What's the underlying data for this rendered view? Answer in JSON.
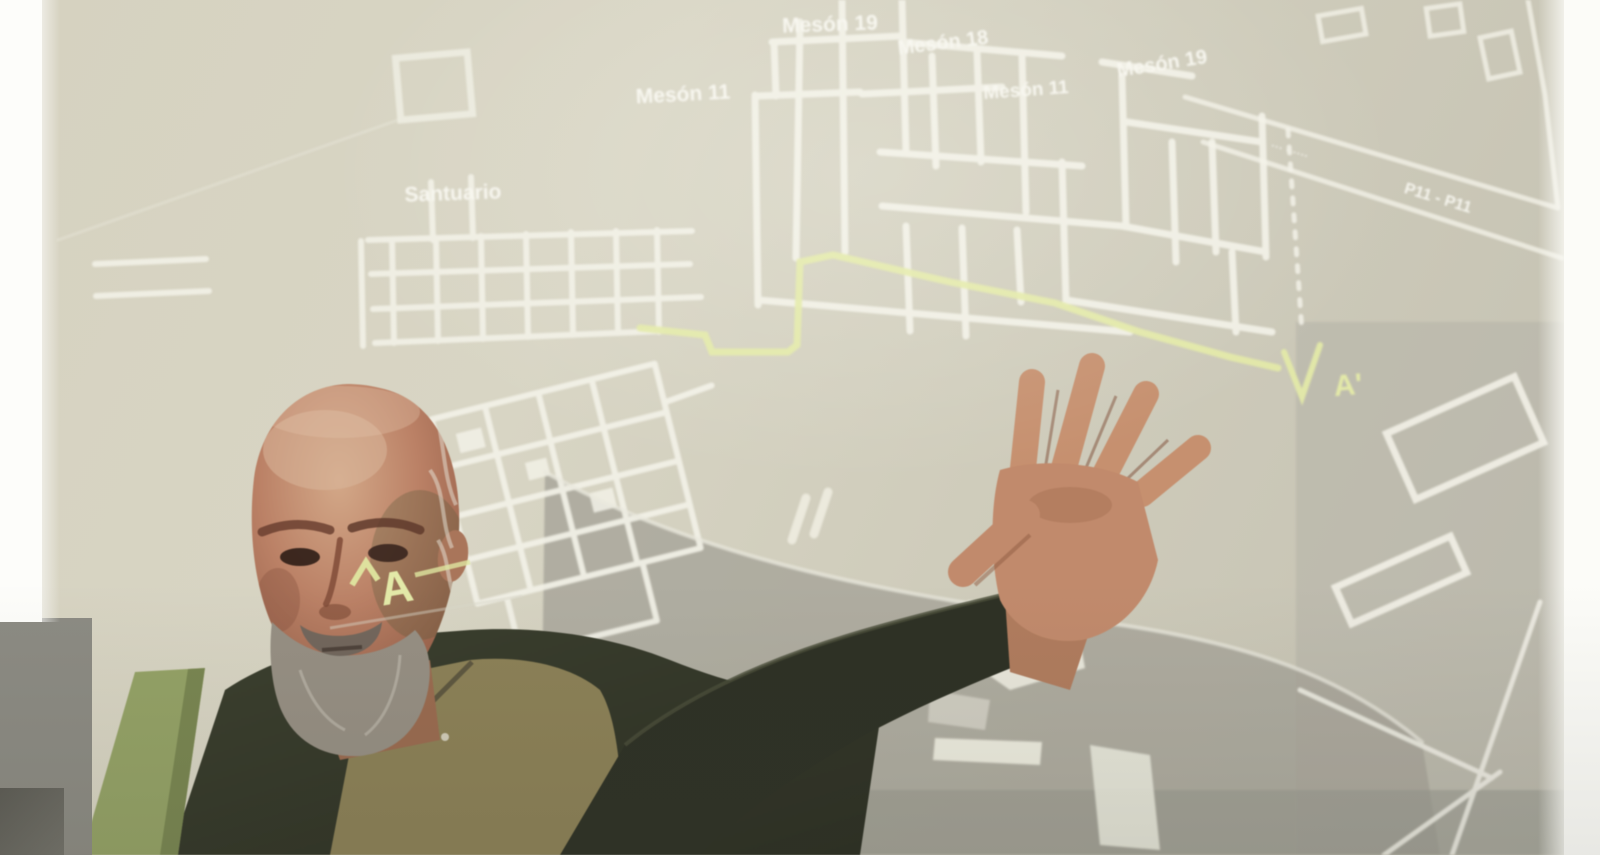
{
  "map": {
    "labels": [
      {
        "text": "Mesón 11"
      },
      {
        "text": "Mesón 19"
      },
      {
        "text": "Mesón 18"
      },
      {
        "text": "Mesón 11"
      },
      {
        "text": "Mesón 19"
      },
      {
        "text": "Santuario"
      },
      {
        "text": "··· · ····"
      },
      {
        "text": "P11 - P11"
      },
      {
        "text": "A'"
      },
      {
        "text": "A"
      }
    ],
    "colors": {
      "wall_lines": "#f2f1e7",
      "route_line": "#e3e9a8",
      "label_text": "#f7f6ef",
      "screen_beige": "#d6d2c0",
      "shadow_gray": "#a7a59a"
    }
  }
}
